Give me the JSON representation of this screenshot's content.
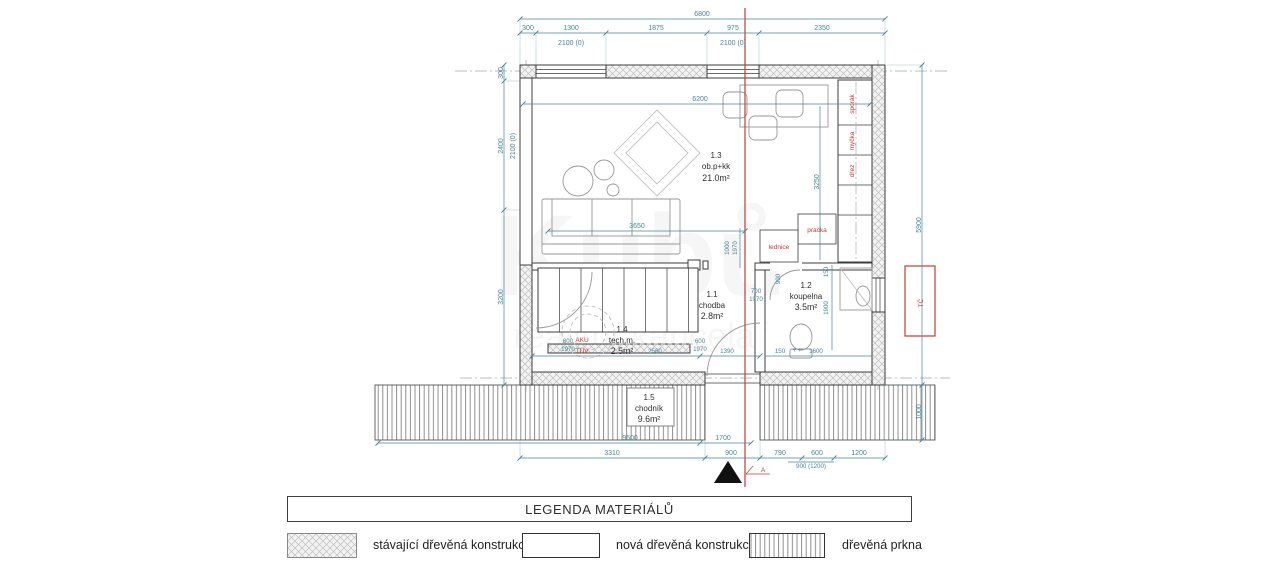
{
  "watermark": {
    "line1": "Kubů",
    "line2": "realitní kancelář"
  },
  "plan": {
    "rooms": {
      "living": {
        "id": "1.3",
        "name": "ob.p+kk",
        "area": "21.0m²"
      },
      "hall": {
        "id": "1.1",
        "name": "chodba",
        "area": "2.8m²"
      },
      "bath": {
        "id": "1.2",
        "name": "koupelna",
        "area": "3.5m²"
      },
      "tech": {
        "id": "1.4",
        "name": "tech.m.",
        "area": "2.5m²"
      },
      "walk": {
        "id": "1.5",
        "name": "chodník",
        "area": "9.6m²"
      }
    },
    "labels": {
      "fridge": "lednice",
      "washer": "pračka",
      "stove": "sporák",
      "dishwasher": "myčka",
      "sink": "dřez",
      "aku": "AKU",
      "tuv": "TÚV",
      "heatpump": "TČ",
      "section": "A"
    },
    "dims": {
      "top_total": "6800",
      "top_1": "300",
      "top_2": "1300",
      "top_3": "1875",
      "top_4": "975",
      "top_5": "2350",
      "top_win1": "2100 (0)",
      "top_win2": "2100 (0)",
      "left_1": "300",
      "left_2": "2400",
      "left_win": "2100 (0)",
      "left_3": "3200",
      "right_1": "5900",
      "right_2": "1000",
      "in_6200": "6200",
      "in_3250": "3250",
      "in_3650": "3650",
      "in_1000": "1000",
      "in_1970a": "1970",
      "in_700": "700",
      "in_1970b": "1970",
      "in_900": "900",
      "in_150a": "150",
      "in_1900": "1900",
      "in_800": "800",
      "in_1970c": "1970",
      "in_2560": "2560",
      "in_600": "600",
      "in_1970d": "1970",
      "in_1390": "1390",
      "in_150b": "150",
      "in_plus": "+ +",
      "in_1600": "1600",
      "bot_9500": "9500",
      "bot_1700": "1700",
      "bot_3310": "3310",
      "bot_900": "900",
      "bot_790": "790",
      "bot_600": "600",
      "bot_1200": "1200",
      "bot_900_1200": "900 (1200)"
    }
  },
  "legend": {
    "title": "LEGENDA MATERIÁLŮ",
    "items": [
      {
        "label": "stávající dřevěná konstrukce",
        "swatch": "crosshatch"
      },
      {
        "label": "nová dřevěná konstrukce",
        "swatch": "plain"
      },
      {
        "label": "dřevěná prkna",
        "swatch": "planks"
      }
    ]
  },
  "colors": {
    "dimension": "#47859a",
    "annotation_red": "#c23b32",
    "wall": "#3c3c3c"
  }
}
